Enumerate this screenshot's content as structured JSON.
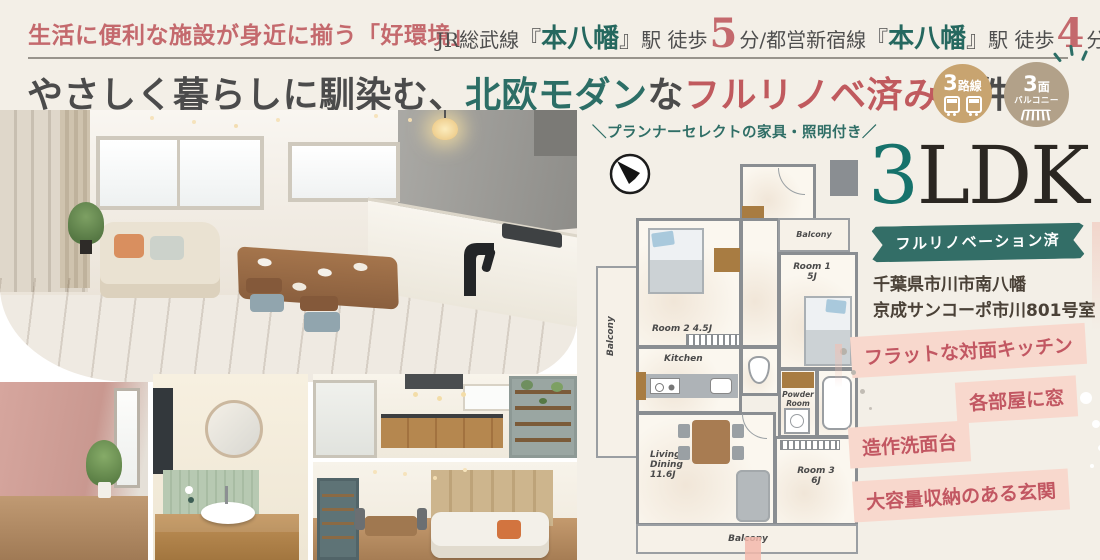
{
  "header": {
    "catchphrase": "生活に便利な施設が身近に揃う「好環境」",
    "access": {
      "rail1": "JR総武線",
      "bracket_open1": "『",
      "station1": "本八幡",
      "bracket_close1": "』",
      "walk1": "駅 徒歩",
      "min1": "5",
      "unit1": "分",
      "slash": "/",
      "rail2": "都営新宿線",
      "bracket_open2": "『",
      "station2": "本八幡",
      "bracket_close2": "』",
      "walk2": "駅 徒歩",
      "min2": "4",
      "unit2": "分"
    }
  },
  "title": {
    "seg_gray1": "やさしく暮らしに馴染む、",
    "seg_teal": "北欧モダン",
    "seg_gray2": "な",
    "seg_pink": "フルリノベ済み",
    "seg_gray3": "物件"
  },
  "badges": [
    {
      "num": "3",
      "label": "路線"
    },
    {
      "num": "3",
      "unit": "面",
      "label": "バルコニー"
    }
  ],
  "furniture_note": "＼プランナーセレクトの家具・照明付き／",
  "property": {
    "ldk_num": "3",
    "ldk_text": "LDK",
    "ribbon": "フルリノベーション済",
    "address_line1": "千葉県市川市南八幡",
    "address_line2": "京成サンコーポ市川801号室"
  },
  "features": [
    "フラットな対面キッチン",
    "各部屋に窓",
    "造作洗面台",
    "大容量収納のある玄関"
  ],
  "floorplan": {
    "balcony_left": "Balcony",
    "balcony_top": "Balcony",
    "balcony_bottom": "Balcony",
    "room2": "Room 2  4.5J",
    "room1_l1": "Room 1",
    "room1_l2": "5J",
    "kitchen": "Kitchen",
    "powder_l1": "Powder",
    "powder_l2": "Room",
    "living_l1": "Living",
    "living_l2": "Dining",
    "living_l3": "11.6J",
    "room3_l1": "Room 3",
    "room3_l2": "6J"
  },
  "colors": {
    "accent_pink": "#c4696d",
    "accent_teal": "#2c6e66",
    "badge_tan": "#c8a470",
    "badge_taupe": "#b2a189",
    "tag_bg": "#f8d8cd",
    "tag_text": "#c25762",
    "ribbon_teal": "#336e67"
  }
}
